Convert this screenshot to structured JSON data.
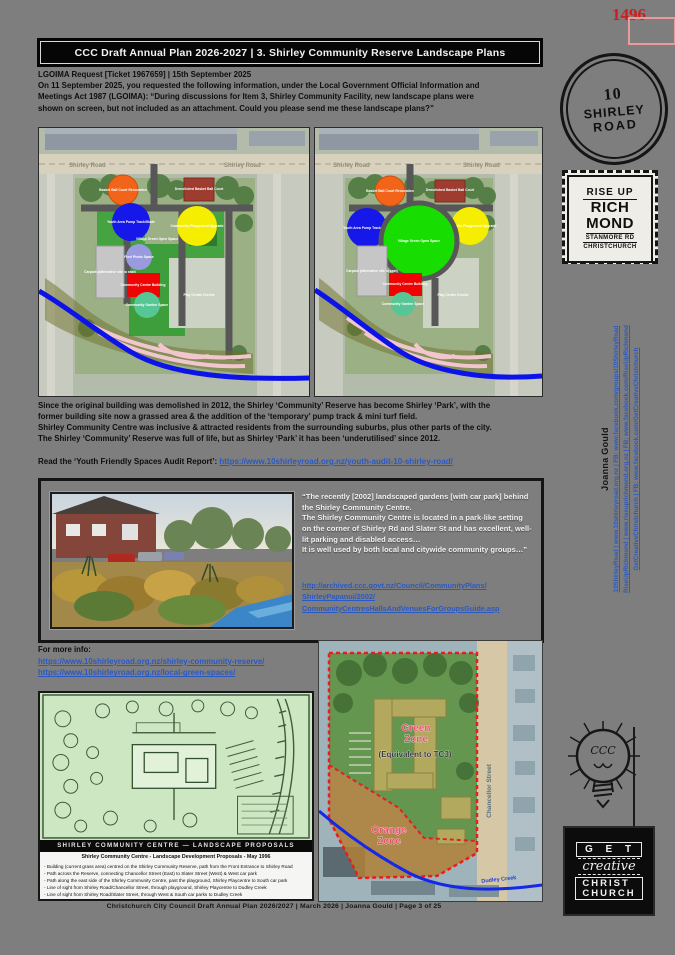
{
  "colors": {
    "link_blue": "#2b59c3",
    "stamp_red": "#cf1d1d",
    "header_bg": "#060606",
    "page_bg": "#7e7e7e"
  },
  "page_number_stamp": "1496",
  "header": {
    "title": "CCC Draft Annual Plan 2026-2027 | 3. Shirley Community Reserve Landscape Plans"
  },
  "request": {
    "heading": "LGOIMA Request [Ticket 1967659] | 15th September 2025",
    "line1": "On 11 September 2025, you requested the following information, under the Local Government Official Information and",
    "line2": "Meetings Act 1987 (LGOIMA): “During discussions for Item 3, Shirley Community Facility, new landscape plans were",
    "line3": "shown on screen, but not included as an attachment. Could you please send me these landscape plans?”"
  },
  "map_labels": {
    "road": "Shirley Road",
    "bball_reno": "Basket Ball Court Renovation",
    "bball_demo": "Demolished Basket Ball Court",
    "youth": "Youth Area Pump Track/Skate",
    "playground": "Community Playground Upgrade",
    "village": "Village Green Open Space",
    "flexi": "Flexi Picnic Space",
    "carpark": "Carpark (alternative site to east)",
    "centre": "Community Centre Building",
    "garden": "Community Garden Space",
    "playcentre": "Play Centre Creche"
  },
  "body": {
    "line1": "Since the original building was demolished in 2012, the Shirley ‘Community’ Reserve has become Shirley ‘Park’, with the",
    "line2": "former building site now a grassed area & the addition of the ‘temporary’ pump track & mini turf field.",
    "line3": "Shirley Community Centre was inclusive & attracted residents from the surrounding suburbs, plus other parts of the city.",
    "line4": "The Shirley ‘Community’ Reserve was full of life, but as Shirley ‘Park’ it has been ‘underutilised’ since 2012."
  },
  "audit": {
    "label": "Read the ‘Youth Friendly Spaces Audit Report’: ",
    "link": "https://www.10shirleyroad.org.nz/youth-audit-10-shirley-road/"
  },
  "quote": {
    "line1": "“The recently [2002] landscaped gardens [with car park] behind the Shirley Community Centre.",
    "line2": "The Shirley Community Centre is located in a park-like setting on the corner of Shirley Rd and Slater St and has excellent, well-lit parking and disabled access…",
    "line3": "It is well used by both local and citywide community groups…”",
    "link_line1": "http://archived.ccc.govt.nz/Council/CommunityPlans/",
    "link_line2": "ShirleyPapanui/2002/",
    "link_line3": "CommunityCentresHallsAndVenuesForGroupsGuide.asp"
  },
  "more_info": {
    "label": "For more info:",
    "link1": "https://www.10shirleyroad.org.nz/shirley-community-reserve/",
    "link2": "https://www.10shirleyroad.org.nz/local-green-spaces/"
  },
  "plan": {
    "title_bar": "SHIRLEY COMMUNITY CENTRE — LANDSCAPE PROPOSALS",
    "caption_title": "Shirley Community Centre - Landscape Development Proposals - May 1996",
    "notes": [
      "- Building (current grass area) centred on the Shirley Community Reserve, path from the Front Entrance to Shirley Road",
      "- Path across the Reserve, connecting Chancellor Street (East) to Slater Street (West) & West car park",
      "- Path along the east side of the Shirley Community Centre, past the playground, Shirley Playcentre to South car park",
      "- Line of sight from Shirley Road/Chancellor Street, through playground, Shirley Playcentre to Dudley Creek",
      "- Line of sight from Shirley Road/Slater Street, through West & South car parks to Dudley Creek"
    ]
  },
  "zone_map": {
    "green_line1": "Green",
    "green_line2": "Zone",
    "green_sub": "(Equivalent to TC3)",
    "orange_line1": "Orange",
    "orange_line2": "Zone",
    "street": "Chancellor Street",
    "creek": "Dudley Creek"
  },
  "footer": "Christchurch City Council Draft Annual Plan 2026/2027   |   March 2026   |   Joanna Gould   |   Page 3 of 25",
  "sidebar": {
    "stamp_circle": {
      "line1": "10",
      "line2": "SHIRLEY",
      "line3": "ROAD"
    },
    "stamp_rise": {
      "line1": "RISE UP",
      "line2": "RICH",
      "line3": "MOND",
      "line4": "STANMORE RD",
      "line5": "CHRISTCHURCH"
    },
    "contact": {
      "name": "Joanna Gould",
      "line1": "10ShirleyRoad | www.10shirleyroad.org.nz | FB: www.facebook.com/groups/10ShirleyRoad",
      "line2": "RiseUpRichmond | www.riseuprichmond.org.nz | FB: www.facebook.com/RiseUpRichmond",
      "line3": "GetCreativeChristchurch | FB: www.facebook.com/GetCreativeChristchurch"
    },
    "stamp_bulb": "CCC",
    "stamp_creative": {
      "line1": "G E T",
      "line2": "creative",
      "line3": "CHRIST",
      "line4": "CHURCH"
    }
  }
}
